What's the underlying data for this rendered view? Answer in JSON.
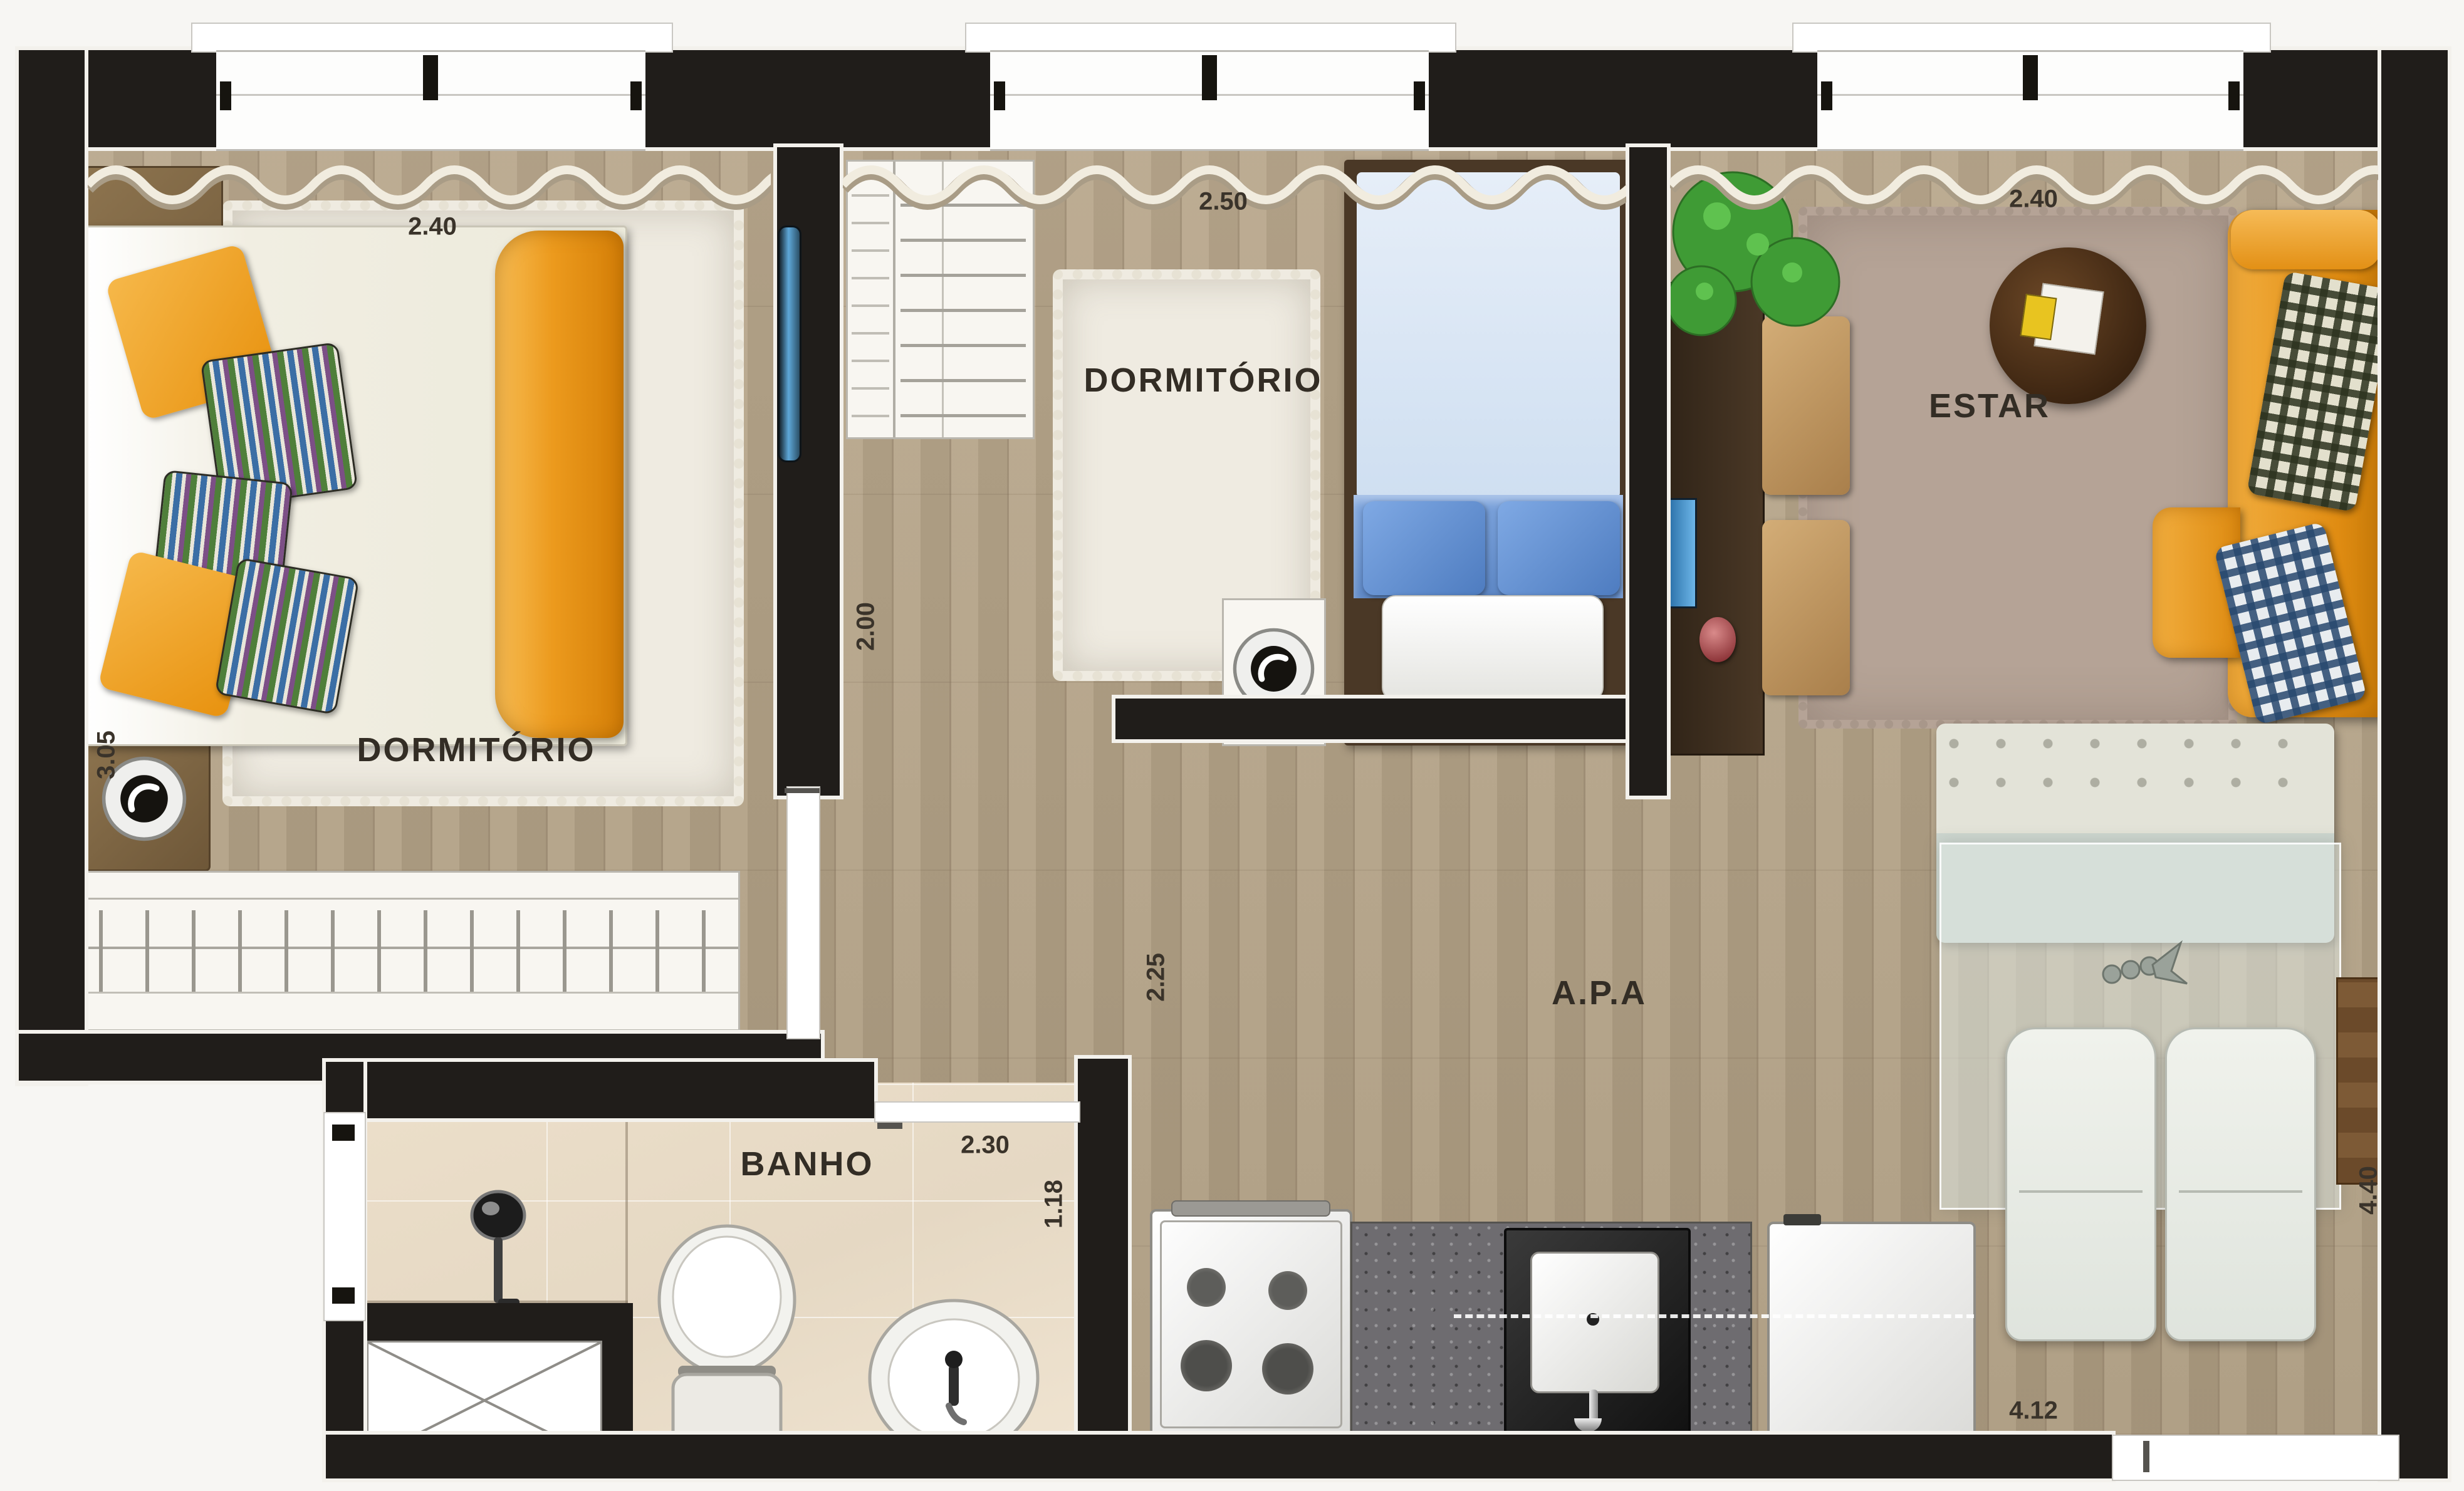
{
  "plan": {
    "rooms": {
      "bedroom1": {
        "name": "DORMITÓRIO",
        "width": "2.40",
        "depth": "3.05"
      },
      "bedroom2": {
        "name": "DORMITÓRIO",
        "width": "2.50",
        "depth": "2.00"
      },
      "living": {
        "name": "ESTAR",
        "width": "2.40",
        "depth": "4.40"
      },
      "bathroom": {
        "name": "BANHO",
        "width": "2.30",
        "depth": "1.18"
      },
      "apartment": {
        "name": "A.P.A",
        "hall_width": "2.25",
        "kitchen_width": "4.12"
      }
    },
    "icons": {
      "speaker": "speaker-icon",
      "double_bed": "double-bed-icon",
      "single_bed": "single-bed-icon",
      "wardrobe": "wardrobe-icon",
      "sofa": "sofa-icon",
      "coffee_table": "coffee-table-icon",
      "plant": "plant-icon",
      "dining_table": "dining-table-icon",
      "toilet": "toilet-icon",
      "sink": "sink-icon",
      "shower": "shower-icon",
      "stove": "stove-icon",
      "fridge": "fridge-icon"
    },
    "colors": {
      "wall": "#201d1a",
      "floor_wood": "#b3a288",
      "tile": "#e9decb",
      "rug_white": "#efebe1",
      "rug_taupe": "#b5a396",
      "accent_orange": "#ec9c2c",
      "accent_blue": "#9cb9e0",
      "counter_gray": "#6e6c70"
    }
  }
}
